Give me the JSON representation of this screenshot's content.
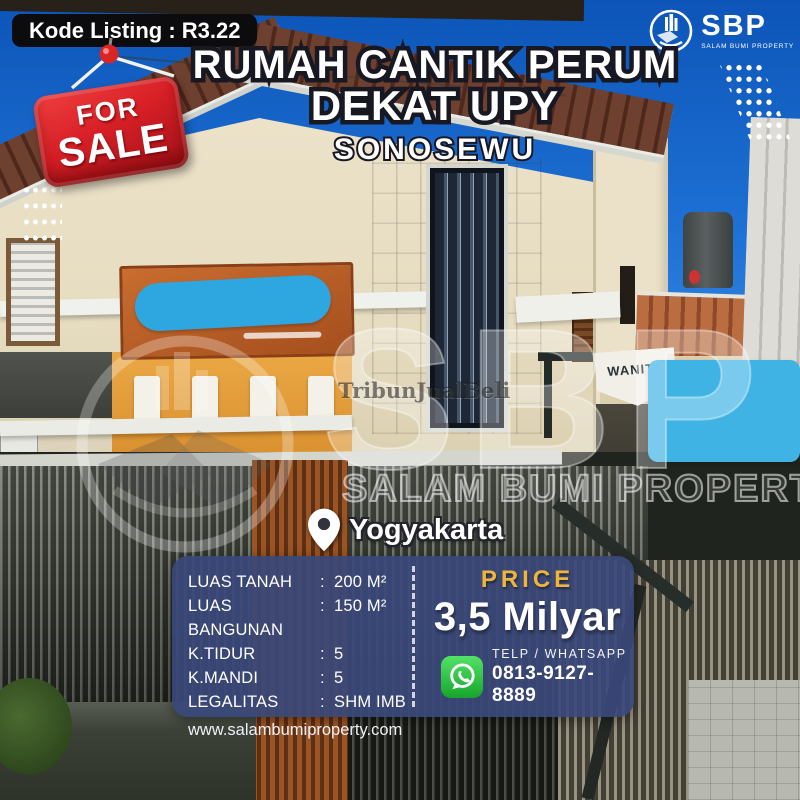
{
  "badge": {
    "kode_listing": "Kode Listing : R3.22"
  },
  "brand": {
    "name": "SBP",
    "tagline": "SALAM BUMI PROPERTY"
  },
  "sale_tag": {
    "line1": "FOR",
    "line2": "SALE"
  },
  "heading": {
    "title_line1": "RUMAH CANTIK PERUM",
    "title_line2": "DEKAT UPY",
    "subtitle": "SONOSEWU"
  },
  "location": {
    "city": "Yogyakarta"
  },
  "photo": {
    "signs": {
      "wanita_sign": "WANITA"
    },
    "watermarks": {
      "press": "TribunJualBeli",
      "brand_letters": "SBP",
      "brand_text": "SALAM BUMI PROPERTY"
    }
  },
  "details": {
    "separator": ":",
    "rows": [
      {
        "label": "LUAS TANAH",
        "value": "200 M²"
      },
      {
        "label": "LUAS BANGUNAN",
        "value": "150 M²"
      },
      {
        "label": "K.TIDUR",
        "value": "5"
      },
      {
        "label": "K.MANDI",
        "value": "5"
      },
      {
        "label": "LEGALITAS",
        "value": "SHM IMB"
      }
    ],
    "website": "www.salambumiproperty.com"
  },
  "price": {
    "label": "PRICE",
    "value": "3,5 Milyar"
  },
  "contact": {
    "label": "TELP / WHATSAPP",
    "phone": "0813-9127-8889"
  },
  "colors": {
    "sky_blue": "#2b7fe0",
    "panel_navy": "#3a4878",
    "price_gold": "#efb53b",
    "sale_red": "#d71f26",
    "whatsapp_green": "#2fc043",
    "censor_blue": "#3ab3e6",
    "badge_black": "#0c0c0e",
    "title_fill": "#ffffff",
    "title_outline": "#181822"
  }
}
